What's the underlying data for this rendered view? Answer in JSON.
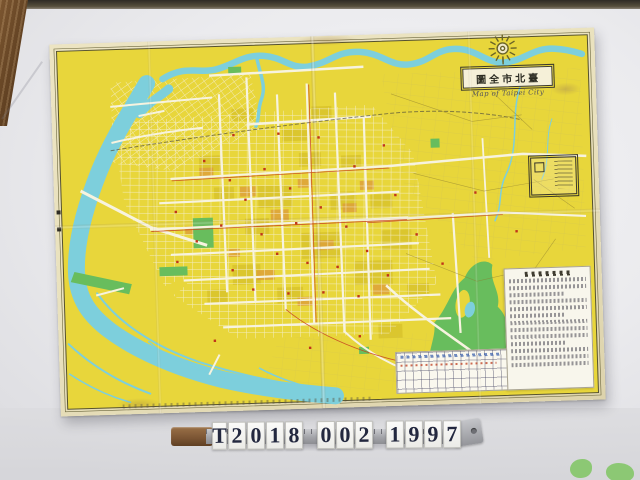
{
  "map": {
    "title_display": "圖全市北臺",
    "title_reading": "臺北市全圖",
    "title_en": "Map of Taipei City"
  },
  "catalog": {
    "number": "T2018 002 1997",
    "groups": [
      [
        "T",
        "2",
        "0",
        "1",
        "8"
      ],
      [
        "0",
        "0",
        "2"
      ],
      [
        "1",
        "9",
        "9",
        "7"
      ]
    ]
  },
  "colors": {
    "map_yellow": "#e8d63b",
    "river_cyan": "#7dcfdc",
    "park_green": "#68bd5d",
    "road_white": "#f7f3df",
    "accent_red": "#c7401f",
    "margin_cream": "#e9e1bd",
    "backdrop_gray": "#e9e9ec",
    "tile_ink": "#23283f"
  }
}
